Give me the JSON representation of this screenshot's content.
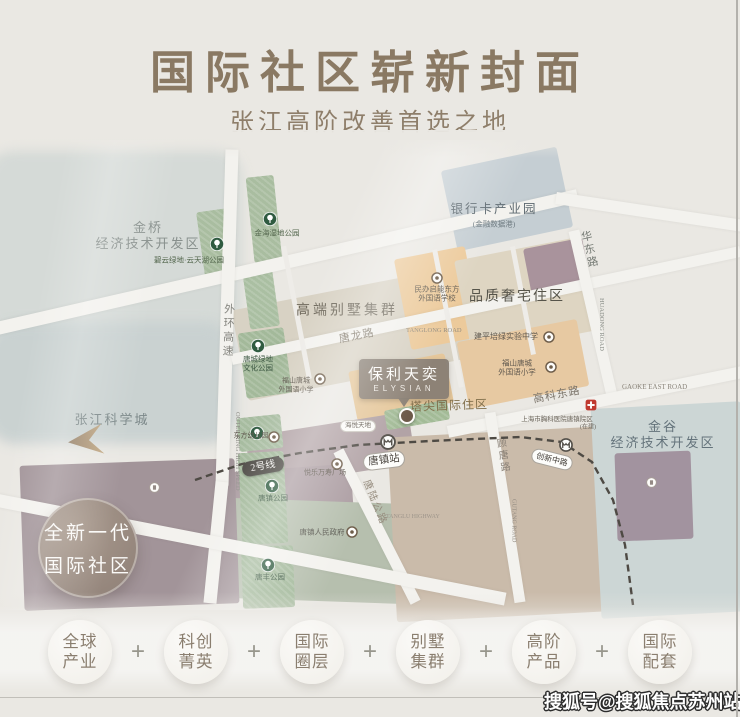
{
  "page": {
    "bg": "#eae8e3",
    "accent_title": "#8a7963"
  },
  "header": {
    "title": "国际社区崭新封面",
    "subtitle": "张江高阶改善首选之地"
  },
  "map": {
    "callout": {
      "title": "保利天奕",
      "en": "ELYSIAN"
    },
    "badge": {
      "line1": "全新一代",
      "line2": "国际社区"
    },
    "metro": {
      "line_badge": "2号线",
      "station": "唐镇站",
      "station2": "创新中路"
    },
    "labels": [
      {
        "n": "jinqiao-district-label",
        "t": "金桥\n经济技术开发区",
        "x": 148,
        "y": 236,
        "s": 13,
        "c": "#88908d",
        "ls": 2
      },
      {
        "n": "biyun-park-label",
        "t": "碧云绿地·云天湖公园",
        "x": 189,
        "y": 260,
        "s": 7.5,
        "c": "#55684f"
      },
      {
        "n": "jinhai-wetland-park-label",
        "t": "金海湿地公园",
        "x": 277,
        "y": 233,
        "s": 7.5,
        "c": "#55684f"
      },
      {
        "n": "bankcard-industry-park-label",
        "t": "银行卡产业园",
        "x": 494,
        "y": 210,
        "s": 12.5,
        "c": "#5d6970",
        "ls": 2
      },
      {
        "n": "financial-data-port-label",
        "t": "(金融数据港)",
        "x": 494,
        "y": 224,
        "s": 7.5,
        "c": "#6e7a80"
      },
      {
        "n": "huadong-road-label",
        "t": "华东路",
        "x": 588,
        "y": 250,
        "s": 11,
        "c": "#757a74",
        "v": 1,
        "r": -13,
        "ls": 2
      },
      {
        "n": "huadong-road-en-label",
        "t": "HUADONG ROAD",
        "x": 597,
        "y": 298,
        "s": 6.5,
        "c": "#8a8e88",
        "v": 1,
        "r": -13,
        "f": "sans"
      },
      {
        "n": "villa-cluster-label",
        "t": "高端别墅集群",
        "x": 347,
        "y": 311,
        "s": 14,
        "c": "#6f695c",
        "ls": 3
      },
      {
        "n": "quality-residence-label",
        "t": "品质奢宅住区",
        "x": 517,
        "y": 297,
        "s": 14,
        "c": "#56544a",
        "ls": 2
      },
      {
        "n": "qineng-school-label",
        "t": "民办启能东方\n外国语学校",
        "x": 437,
        "y": 294,
        "s": 7.5,
        "c": "#5f584e"
      },
      {
        "n": "tanglong-road-label",
        "t": "唐龙路",
        "x": 357,
        "y": 337,
        "s": 11,
        "c": "#837b6d",
        "r": -11,
        "ls": 1
      },
      {
        "n": "tanglong-road-en-label",
        "t": "TANGLONG ROAD",
        "x": 406,
        "y": 327,
        "s": 6.5,
        "c": "#958d7f",
        "r": -11,
        "f": "sans"
      },
      {
        "n": "outer-ring-label",
        "t": "外环高速",
        "x": 227,
        "y": 331,
        "s": 11,
        "c": "#85857f",
        "v": 1,
        "r": 2,
        "ls": 3
      },
      {
        "n": "outer-ring-en-label",
        "t": "OUTER RING HIGH SPEED",
        "x": 233,
        "y": 412,
        "s": 6.5,
        "c": "#8f8f89",
        "v": 1,
        "r": 2,
        "f": "sans"
      },
      {
        "n": "zhangjiang-science-city-label",
        "t": "张江科学城",
        "x": 112,
        "y": 420,
        "s": 13,
        "c": "#7c8889",
        "ls": 2
      },
      {
        "n": "tangcheng-culture-park-label",
        "t": "唐城绿地\n文化公园",
        "x": 258,
        "y": 364,
        "s": 7.5,
        "c": "#3f5a45"
      },
      {
        "n": "fushan-primary-west-label",
        "t": "福山唐城\n外国语小学",
        "x": 296,
        "y": 385,
        "s": 7,
        "c": "#5f584e"
      },
      {
        "n": "jianping-middle-school-label",
        "t": "建平培绿实验中学",
        "x": 506,
        "y": 337,
        "s": 8,
        "c": "#5f584e"
      },
      {
        "n": "fushan-primary-east-label",
        "t": "福山唐城\n外国语小学",
        "x": 517,
        "y": 368,
        "s": 7.5,
        "c": "#5f584e"
      },
      {
        "n": "pinnacle-residence-label",
        "t": "塔尖国际住区",
        "x": 449,
        "y": 406,
        "s": 12,
        "c": "#82704c",
        "ls": 1,
        "r": -2
      },
      {
        "n": "gaoke-east-road-label",
        "t": "高科东路",
        "x": 557,
        "y": 396,
        "s": 11,
        "c": "#7b746a",
        "r": -11,
        "ls": 1
      },
      {
        "n": "gaoke-east-road-en-label",
        "t": "GAOKE EAST ROAD",
        "x": 622,
        "y": 383,
        "s": 7,
        "c": "#8b857b",
        "r": -11,
        "f": "sans"
      },
      {
        "n": "gutang-road-label",
        "t": "顾唐路",
        "x": 501,
        "y": 456,
        "s": 10,
        "c": "#8b8278",
        "v": 1,
        "r": -9,
        "ls": 2
      },
      {
        "n": "gutang-road-en-label",
        "t": "GUTANG ROAD",
        "x": 509,
        "y": 499,
        "s": 6,
        "c": "#958d83",
        "v": 1,
        "r": -9,
        "f": "sans"
      },
      {
        "n": "jingu-district-label",
        "t": "金谷\n经济技术开发区",
        "x": 663,
        "y": 435,
        "s": 13,
        "c": "#64737b",
        "ls": 2
      },
      {
        "n": "hospital-label",
        "t": "上海市胸科医院唐镇院区",
        "x": 557,
        "y": 420,
        "s": 6.5,
        "c": "#6b655b"
      },
      {
        "n": "under-construction-label",
        "t": "(在建)",
        "x": 588,
        "y": 428,
        "s": 6,
        "c": "#6b655b"
      },
      {
        "n": "dongfang-kindergarten-label",
        "t": "东方幼儿园",
        "x": 251,
        "y": 436,
        "s": 7,
        "c": "#5f584e"
      },
      {
        "n": "haiyue-tiandi-label",
        "t": "海悦天地",
        "x": 358,
        "y": 426,
        "s": 6.5,
        "c": "#5f584e",
        "pill": 1
      },
      {
        "n": "yuele-plaza-label",
        "t": "悦乐万寿广场",
        "x": 325,
        "y": 473,
        "s": 7,
        "c": "#5f584e"
      },
      {
        "n": "town-government-label",
        "t": "唐镇人民政府",
        "x": 322,
        "y": 532,
        "s": 7.5,
        "c": "#55544c"
      },
      {
        "n": "tangzhen-park-label",
        "t": "唐镇公园",
        "x": 273,
        "y": 498,
        "s": 7.5,
        "c": "#3f5a45"
      },
      {
        "n": "tangfeng-park-label",
        "t": "唐丰公园",
        "x": 270,
        "y": 577,
        "s": 7.5,
        "c": "#3f5a45"
      },
      {
        "n": "tanglu-highway-label",
        "t": "唐陆公路",
        "x": 374,
        "y": 503,
        "s": 10,
        "c": "#968c7e",
        "r": 68,
        "ls": 2
      },
      {
        "n": "tanglu-highway-en-label",
        "t": "TANGLU HIGHWAY",
        "x": 386,
        "y": 514,
        "s": 6,
        "c": "#9d948a",
        "r": 68,
        "f": "sans"
      }
    ],
    "parks": [
      {
        "x": 217,
        "y": 244
      },
      {
        "x": 270,
        "y": 219
      },
      {
        "x": 258,
        "y": 346
      },
      {
        "x": 257,
        "y": 433
      },
      {
        "x": 272,
        "y": 486
      },
      {
        "x": 268,
        "y": 565
      }
    ],
    "pois": [
      {
        "n": "school-icon",
        "k": "school",
        "x": 437,
        "y": 277
      },
      {
        "n": "school-icon",
        "k": "school",
        "x": 549,
        "y": 336
      },
      {
        "n": "school-icon",
        "k": "school",
        "x": 551,
        "y": 366
      },
      {
        "n": "school-icon",
        "k": "school",
        "x": 320,
        "y": 378
      },
      {
        "n": "kindergarten-icon",
        "k": "school",
        "x": 274,
        "y": 436
      },
      {
        "n": "mall-icon",
        "k": "school",
        "x": 337,
        "y": 463
      },
      {
        "n": "government-icon",
        "k": "school",
        "x": 352,
        "y": 531
      },
      {
        "n": "hospital-icon",
        "k": "hospital",
        "x": 591,
        "y": 404
      },
      {
        "n": "building-icon",
        "k": "building",
        "x": 652,
        "y": 481
      },
      {
        "n": "building-icon",
        "k": "building",
        "x": 155,
        "y": 486
      }
    ]
  },
  "footer": {
    "plus": "+",
    "items": [
      {
        "l1": "全球",
        "l2": "产业"
      },
      {
        "l1": "科创",
        "l2": "菁英"
      },
      {
        "l1": "国际",
        "l2": "圈层"
      },
      {
        "l1": "别墅",
        "l2": "集群"
      },
      {
        "l1": "高阶",
        "l2": "产品"
      },
      {
        "l1": "国际",
        "l2": "配套"
      }
    ]
  },
  "watermark": "搜狐号@搜狐焦点苏州站"
}
